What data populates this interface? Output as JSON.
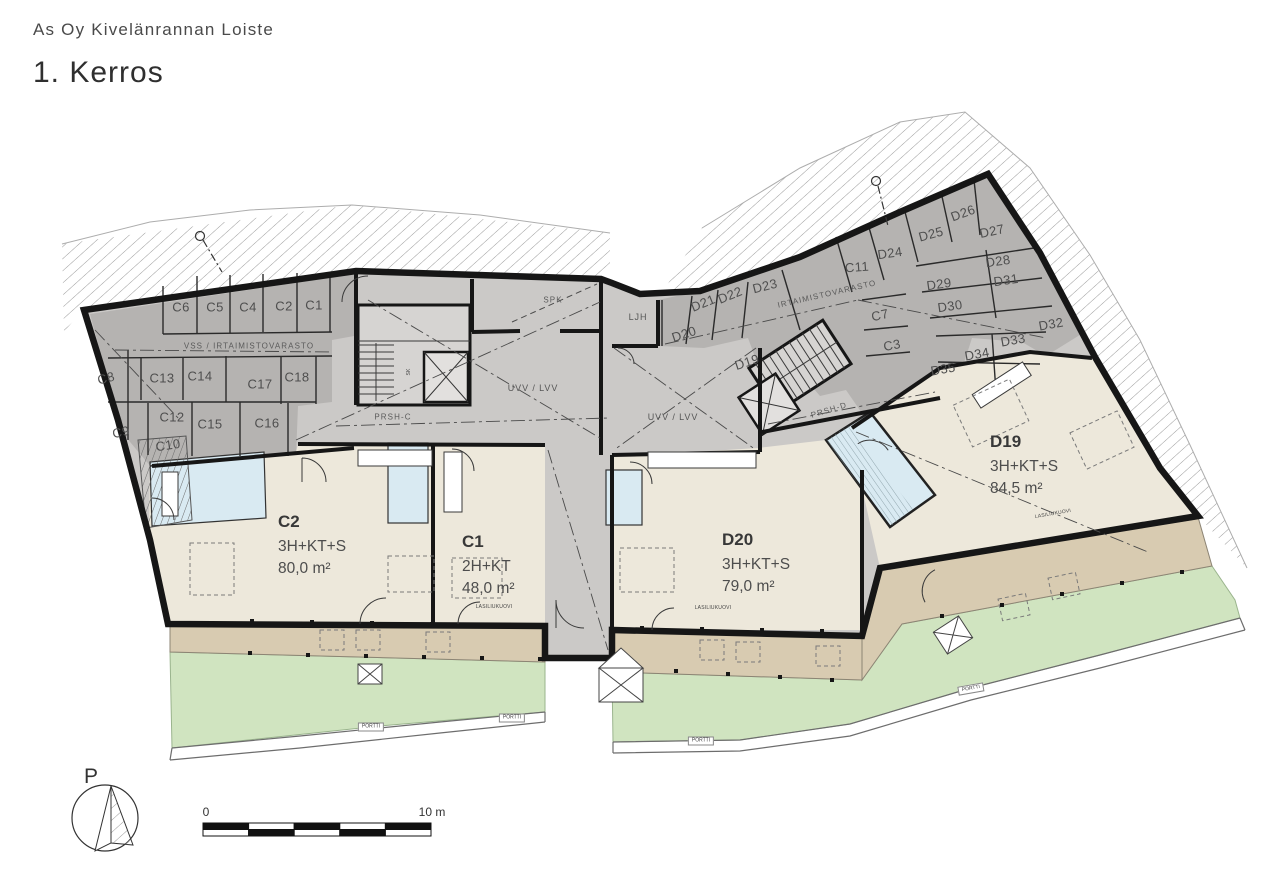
{
  "header": {
    "project": "As Oy Kivelänrannan Loiste",
    "floor": "1. Kerros"
  },
  "apartments": [
    {
      "id": "C2",
      "type": "3H+KT+S",
      "area": "80,0 m²"
    },
    {
      "id": "C1",
      "type": "2H+KT",
      "area": "48,0 m²"
    },
    {
      "id": "D20",
      "type": "3H+KT+S",
      "area": "79,0 m²"
    },
    {
      "id": "D19",
      "type": "3H+KT+S",
      "area": "84,5 m²"
    }
  ],
  "storage_c": {
    "corridor_label": "VSS / IRTAIMISTOVARASTO",
    "rooms": [
      "C6",
      "C5",
      "C4",
      "C2",
      "C1",
      "C8",
      "C13",
      "C14",
      "C17",
      "C18",
      "C12",
      "C15",
      "C16",
      "C9",
      "C10"
    ]
  },
  "storage_d": {
    "corridor_label": "IRTAIMISTOVARASTO",
    "rooms": [
      "D21",
      "D22",
      "D23",
      "C11",
      "D24",
      "D25",
      "D26",
      "D27",
      "D28",
      "D29",
      "D30",
      "D31",
      "D32",
      "D33",
      "D34",
      "D35",
      "C7",
      "C3",
      "D20",
      "D19"
    ]
  },
  "rooms": {
    "spk": "SPK",
    "ljh": "LJH",
    "uvv_left": "UVV / LVV",
    "uvv_right": "UVV / LVV",
    "prsh_c": "PRSH-C",
    "prsh_d": "PRSH-D",
    "sk": "SK"
  },
  "annotations": {
    "sliding_door": "LASILIUKUOVI",
    "gate": "PORTTI"
  },
  "compass": {
    "north_label": "P"
  },
  "scale_bar": {
    "start_label": "0",
    "end_label": "10 m"
  },
  "colors": {
    "storage_fill": "#b5b3b1",
    "common_fill": "#cbc9c7",
    "apartment_fill": "#ede8db",
    "terrace_fill": "#d8cbb1",
    "yard_fill": "#d0e4c0",
    "wet_room_fill": "#d9eaf2",
    "wall": "#161616",
    "text": "#3c3c3c"
  }
}
